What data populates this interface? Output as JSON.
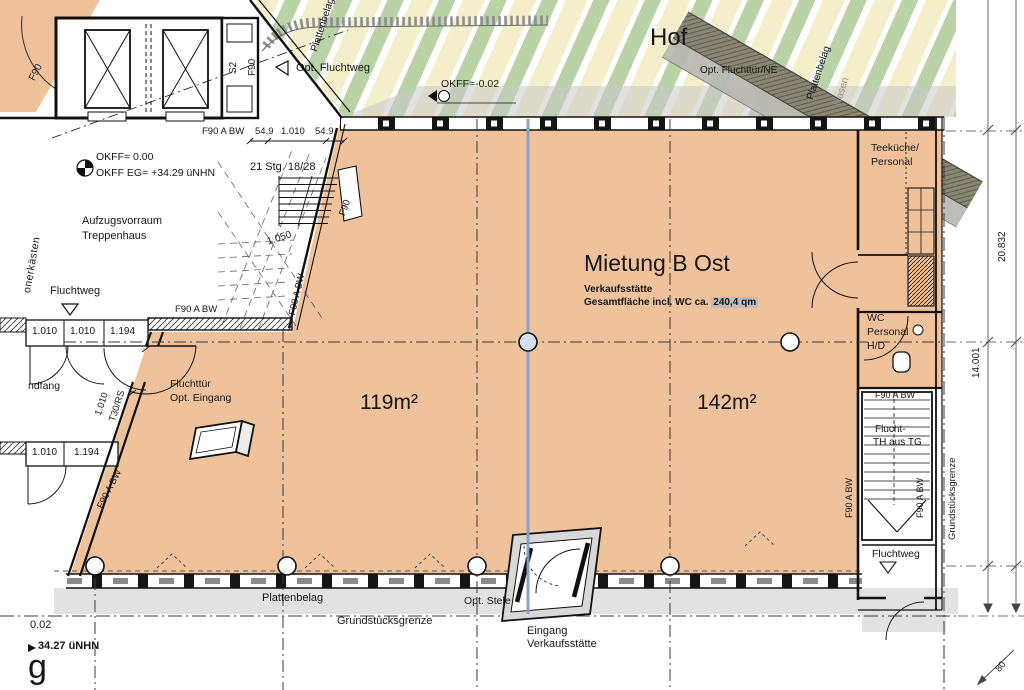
{
  "drawing_title": "Mietung B Ost floor plan",
  "colors": {
    "tenant_orange": "#f0c29b",
    "stripe_green": "#b9d2a6",
    "stripe_yellow": "#f4efca",
    "paving_grey": "#e2e2e2",
    "axis_blue": "#84a0c8",
    "band_dark": "#8a8773",
    "band_light": "#b7b7b0",
    "highlight_grey": "#bdbdbd"
  },
  "labels": {
    "hof_title": "Hof",
    "opt_fluchtweg": "Opt. Fluchtweg",
    "okff_hof": "OKFF=-0.02",
    "opt_fluchttuer_ne": "Opt. Fluchttür/NE",
    "plattenbelag_diag_left": "Plattenbelag",
    "plattenbelag_diag_right": "Plattenbelag",
    "rasen": "Rasen",
    "okff_zero": "OKFF= 0.00",
    "okff_eg": "OKFF EG= +34.29 üNHN",
    "stg": "21 Stg. 18/28",
    "aufzugsvorraum": "Aufzugsvorraum",
    "treppenhaus": "Treppenhaus",
    "fluchtweg_left": "Fluchtweg",
    "kaesten": "onerkästen",
    "s2": "S2",
    "f90_a": "F90",
    "f90_b": "F90",
    "f90_door": "F90",
    "f90abw_dim": "F90 A BW",
    "d549a": "54.9",
    "d1010t": "1.010",
    "d549b": "54.9",
    "d1050": "1.050",
    "f90abw_stair": "F90 A BW",
    "f90abw_wall": "F90 A BW",
    "dim1a": "1.010",
    "dim1b": "1.010",
    "dim1c": "1.194",
    "dim_rot": "1.010",
    "t30rs": "T30/RS",
    "fluchttuer": "Fluchttür",
    "opt_eingang": "Opt. Eingang",
    "windfang": "ndfang",
    "dim2a": "1.010",
    "dim2b": "1.194",
    "f90abw_diag": "F90 A BW",
    "mietung_title": "Mietung B Ost",
    "verkaufsstaette": "Verkaufsstätte",
    "gesamtflaeche": "Gesamtfläche incl. WC ca.",
    "qm": "240,4 qm",
    "area_left": "119m²",
    "area_right": "142m²",
    "teekueche": "Teeküche/",
    "personal1": "Personal",
    "wc": "WC",
    "personal2": "Personal",
    "hd": "H/D",
    "f90abw_strip_top": "F90 A BW",
    "flucht_th1": "Flucht-",
    "flucht_th2": "TH aus TG",
    "f90abw_v_left": "F90 A BW",
    "f90abw_v_right": "F90 A BW",
    "grenze_vertical": "Grundstücksgrenze",
    "fluchtweg_right": "Fluchtweg",
    "plattenbelag_bottom": "Plattenbelag",
    "grenze_bottom": "Grundstücksgrenze",
    "opt_stele": "Opt. Stele",
    "eingang": "Eingang",
    "verkaufsstaette2": "Verkaufsstätte",
    "level_002": "0.02",
    "level_3427": "34.27 üNHN",
    "g_letter": "g",
    "dim_20832": "20.832",
    "dim_14001": "14.001",
    "dim_80": "80"
  }
}
